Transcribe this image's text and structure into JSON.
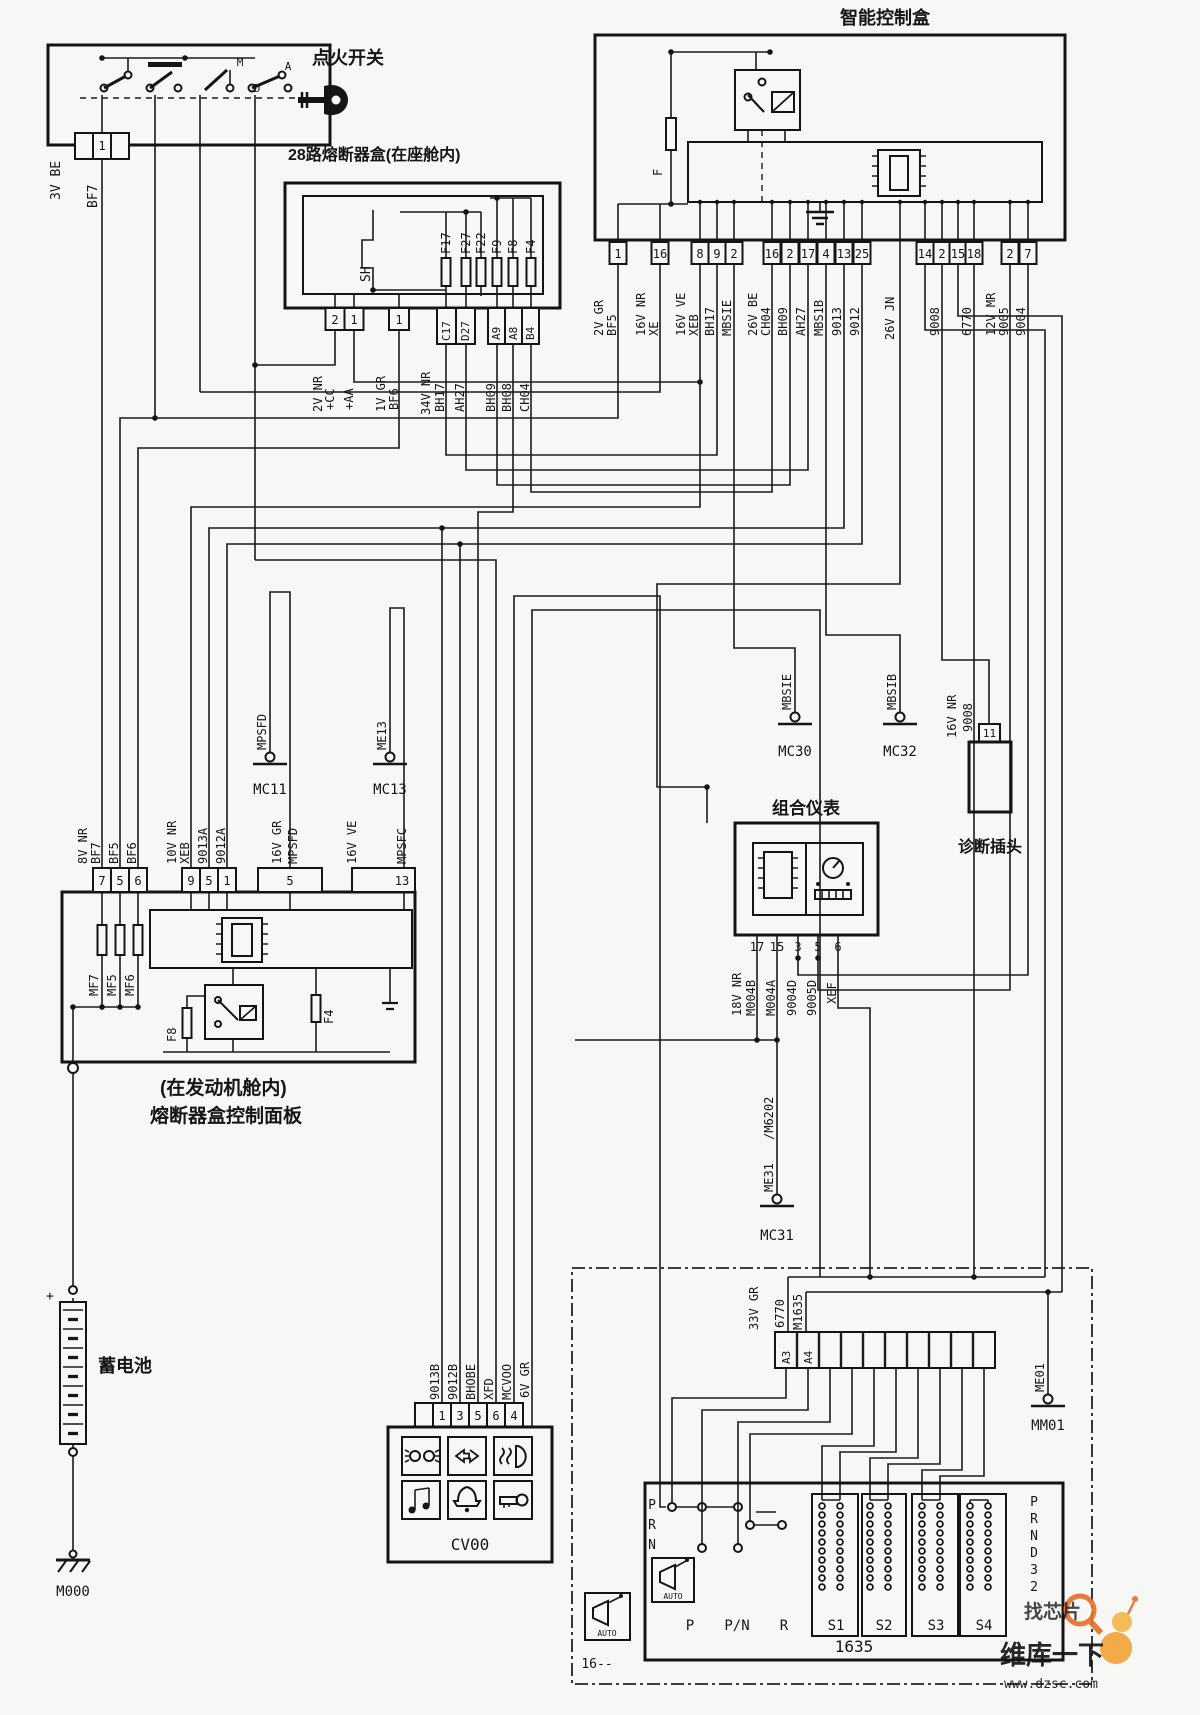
{
  "titles": {
    "ignition": "点火开关",
    "cabin": "28路熔断器盒(在座舱内)",
    "smart": "智能控制盒",
    "cluster": "组合仪表",
    "diag": "诊断插头",
    "engine1": "(在发动机舱内)",
    "engine2": "熔断器盒控制面板",
    "battery": "蓄电池"
  },
  "ignition": {
    "pin": "1",
    "conn": "3V BE",
    "wire": "BF7",
    "m": "M",
    "a": "A",
    "d": "D"
  },
  "cabin": {
    "sh": "SH",
    "fuses": [
      "F17",
      "F27",
      "F22",
      "F9",
      "F8",
      "F4"
    ],
    "pins": [
      "2",
      "1",
      "1",
      "C17",
      "D27",
      "A9",
      "A8",
      "B4"
    ],
    "wires": [
      "2V NR",
      "+CC",
      "+AA",
      "1V GR",
      "BF6",
      "34V NR",
      "BH17",
      "AH27",
      "BH09",
      "BH08",
      "CH04"
    ]
  },
  "smart": {
    "fuse": "F",
    "jn": "26V JN",
    "pins": [
      {
        "n": "1",
        "l1": "2V GR",
        "l2": "BF5"
      },
      {
        "n": "16",
        "l1": "16V NR",
        "l2": "XE"
      },
      {
        "n": "8",
        "l1": "16V VE",
        "l2": "XEB"
      },
      {
        "n": "9",
        "l1": "BH17"
      },
      {
        "n": "2",
        "l1": "MBSIE"
      },
      {
        "n": "16",
        "l1": "26V BE",
        "l2": "CH04"
      },
      {
        "n": "2",
        "l1": "BH09"
      },
      {
        "n": "17",
        "l1": "AH27"
      },
      {
        "n": "4",
        "l1": "MBS1B"
      },
      {
        "n": "13",
        "l1": "9013"
      },
      {
        "n": "25",
        "l1": "9012"
      },
      {
        "n": "14"
      },
      {
        "n": "2",
        "l1": "9008"
      },
      {
        "n": "15"
      },
      {
        "n": "18",
        "l1": "6770"
      },
      {
        "n": "2",
        "l1": "12V MR",
        "l2": "9005"
      },
      {
        "n": "7",
        "l1": "9004"
      }
    ]
  },
  "engine": {
    "p1": [
      "7",
      "5",
      "6"
    ],
    "w1": [
      "8V NR",
      "BF7",
      "BF5",
      "BF6"
    ],
    "p2": [
      "9",
      "5",
      "1"
    ],
    "w2": [
      "10V NR",
      "XEB",
      "9013A",
      "9012A"
    ],
    "p3": "5",
    "w3": [
      "16V GR",
      "MPSFD"
    ],
    "p4": "13",
    "w4": [
      "16V VE",
      "MPSFC"
    ],
    "fuses": [
      "MF7",
      "MF5",
      "MF6",
      "F8",
      "F4"
    ]
  },
  "cluster": {
    "pins": [
      "17",
      "15",
      "3",
      "5",
      "6"
    ],
    "wires": [
      "18V NR",
      "M004B",
      "M004A",
      "9004D",
      "9005D",
      "XEF"
    ]
  },
  "grounds": {
    "mc11": {
      "wire": "MPSFD",
      "name": "MC11"
    },
    "mc13": {
      "wire": "ME13",
      "name": "MC13"
    },
    "mc30": {
      "wire": "MBSIE",
      "name": "MC30"
    },
    "mc32": {
      "wire": "MBSIB",
      "name": "MC32"
    },
    "mc31": {
      "wire1": "/M6202",
      "wire2": "ME31",
      "name": "MC31"
    },
    "mm01": {
      "wire": "ME01",
      "name": "MM01"
    },
    "m000": {
      "name": "M000"
    }
  },
  "diag": {
    "pin": "11",
    "w1": "16V NR",
    "w2": "9008"
  },
  "cv00": {
    "name": "CV00",
    "pins": [
      "1",
      "3",
      "5",
      "6",
      "4"
    ],
    "wires": [
      "9013B",
      "9012B",
      "BHOBE",
      "XFD",
      "MCVOO",
      "6V GR"
    ]
  },
  "bottom": {
    "box": "1635",
    "left": [
      "P",
      "R",
      "N"
    ],
    "right": [
      "P",
      "R",
      "N",
      "D",
      "3",
      "2"
    ],
    "auto": "AUTO",
    "label16": "16--",
    "positions": [
      "P",
      "P/N",
      "R"
    ],
    "solenoids": [
      "S1",
      "S2",
      "S3",
      "S4"
    ],
    "conn": "33V GR",
    "cells": [
      "A3",
      "A4"
    ],
    "wires": [
      "6770",
      "M1635"
    ]
  },
  "watermark": {
    "t1": "找芯片",
    "brand": "维库一下",
    "url": "www.dzsc.com"
  }
}
